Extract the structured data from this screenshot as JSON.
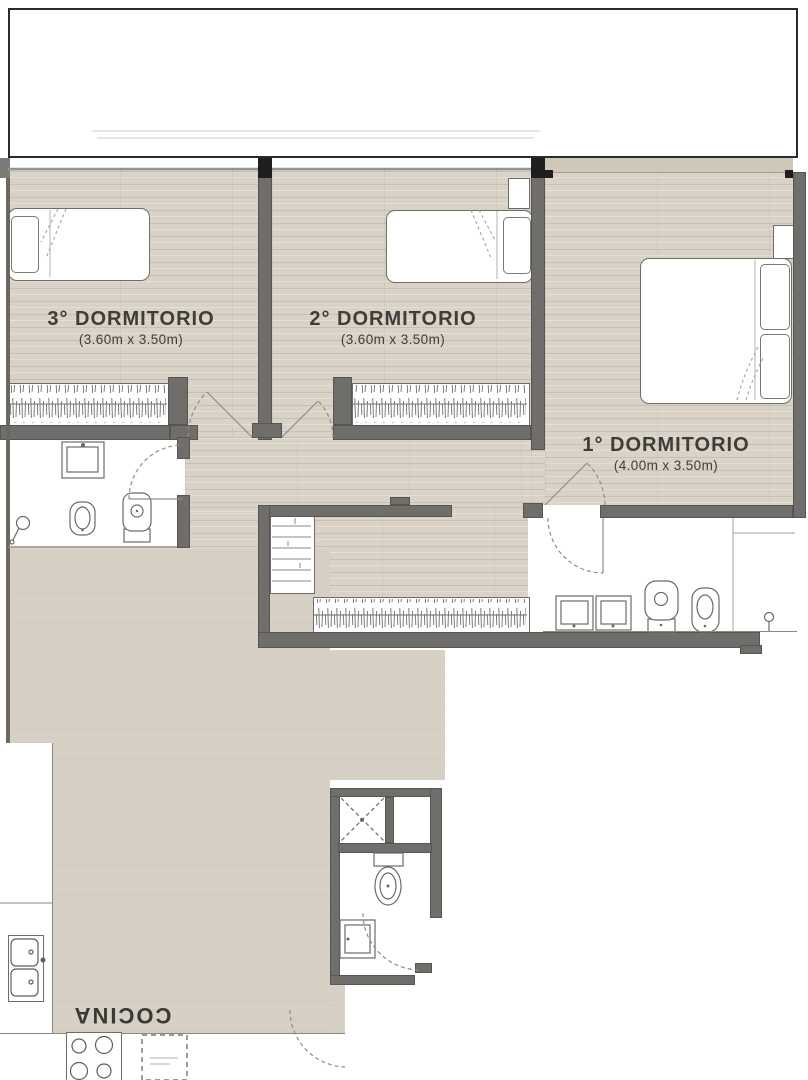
{
  "rooms": {
    "dorm3": {
      "name": "3° DORMITORIO",
      "dims": "(3.60m x 3.50m)"
    },
    "dorm2": {
      "name": "2° DORMITORIO",
      "dims": "(3.60m x 3.50m)"
    },
    "dorm1": {
      "name": "1° DORMITORIO",
      "dims": "(4.00m x 3.50m)"
    },
    "kitchen": {
      "name": "COCINA"
    }
  },
  "colors": {
    "wood_floor": "#d9d2c6",
    "plain_floor": "#d6cfc3",
    "wall_gray": "#6f6e6b",
    "wall_black": "#1f1f1f",
    "fixture_line": "#6d6c68",
    "window_line": "#8f988e",
    "label_text": "#3f3d3a",
    "sill_beige": "#cfc7b9"
  }
}
